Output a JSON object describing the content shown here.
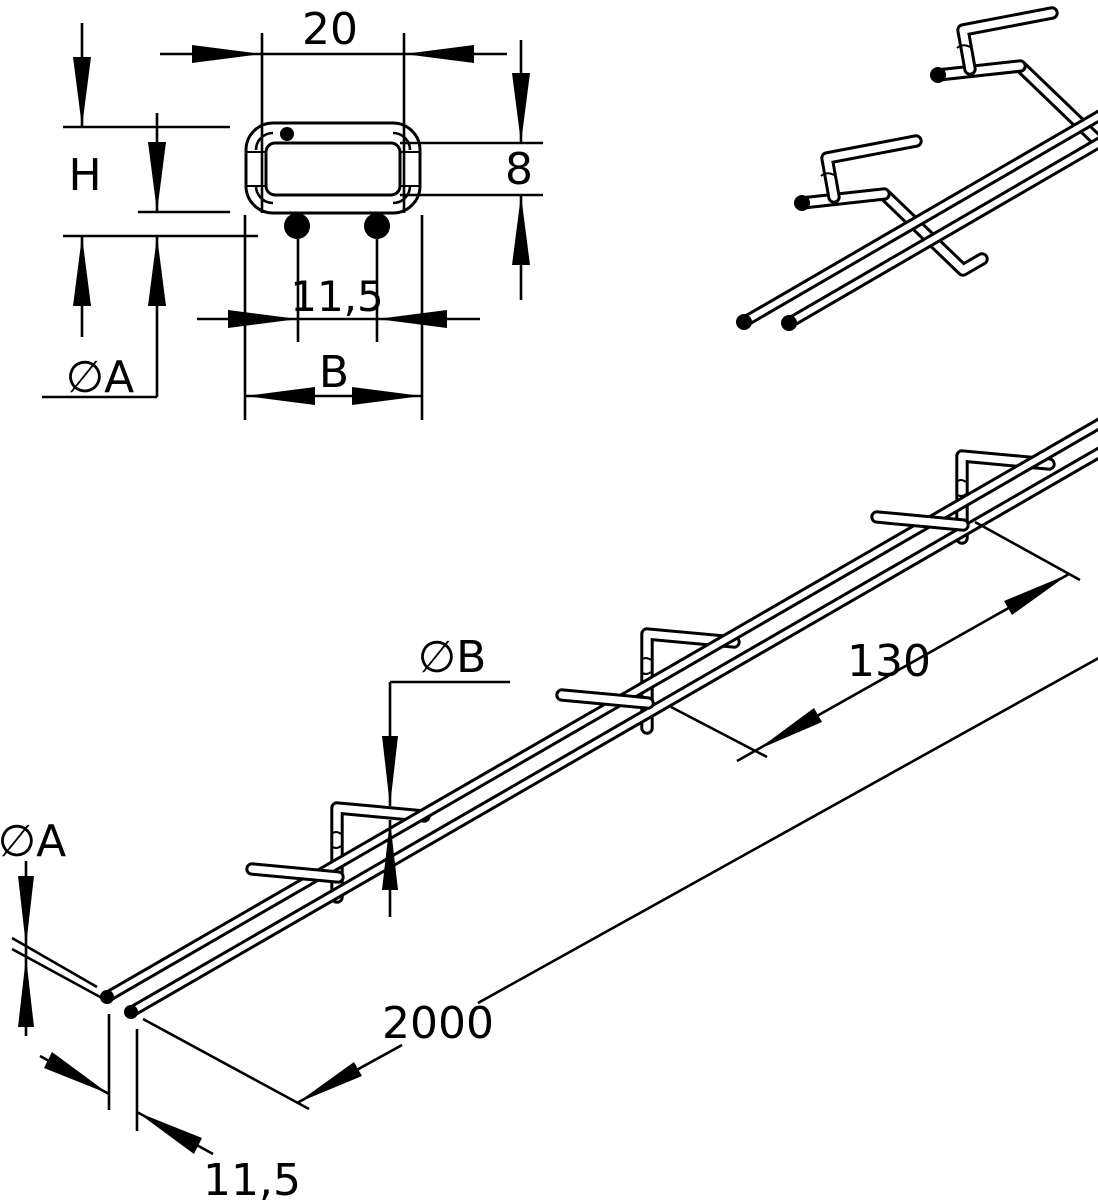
{
  "drawing": {
    "kind": "technical dimension drawing",
    "colors": {
      "background": "#ffffff",
      "line": "#000000"
    },
    "views": {
      "cross_section": {
        "title": "cross-section end view",
        "labels": {
          "width_top": "20",
          "overall_height": "H",
          "inner_height": "8",
          "wire_spacing": "11,5",
          "run_wire_diameter": "∅A",
          "outer_width": "B"
        }
      },
      "iso_detail": {
        "title": "isometric detail view"
      },
      "side_view": {
        "title": "side view",
        "labels": {
          "hook_wire_diameter": "∅B",
          "hook_spacing": "130",
          "overall_length": "2000",
          "wire_spacing": "11,5",
          "run_wire_diameter": "∅A"
        }
      }
    }
  }
}
